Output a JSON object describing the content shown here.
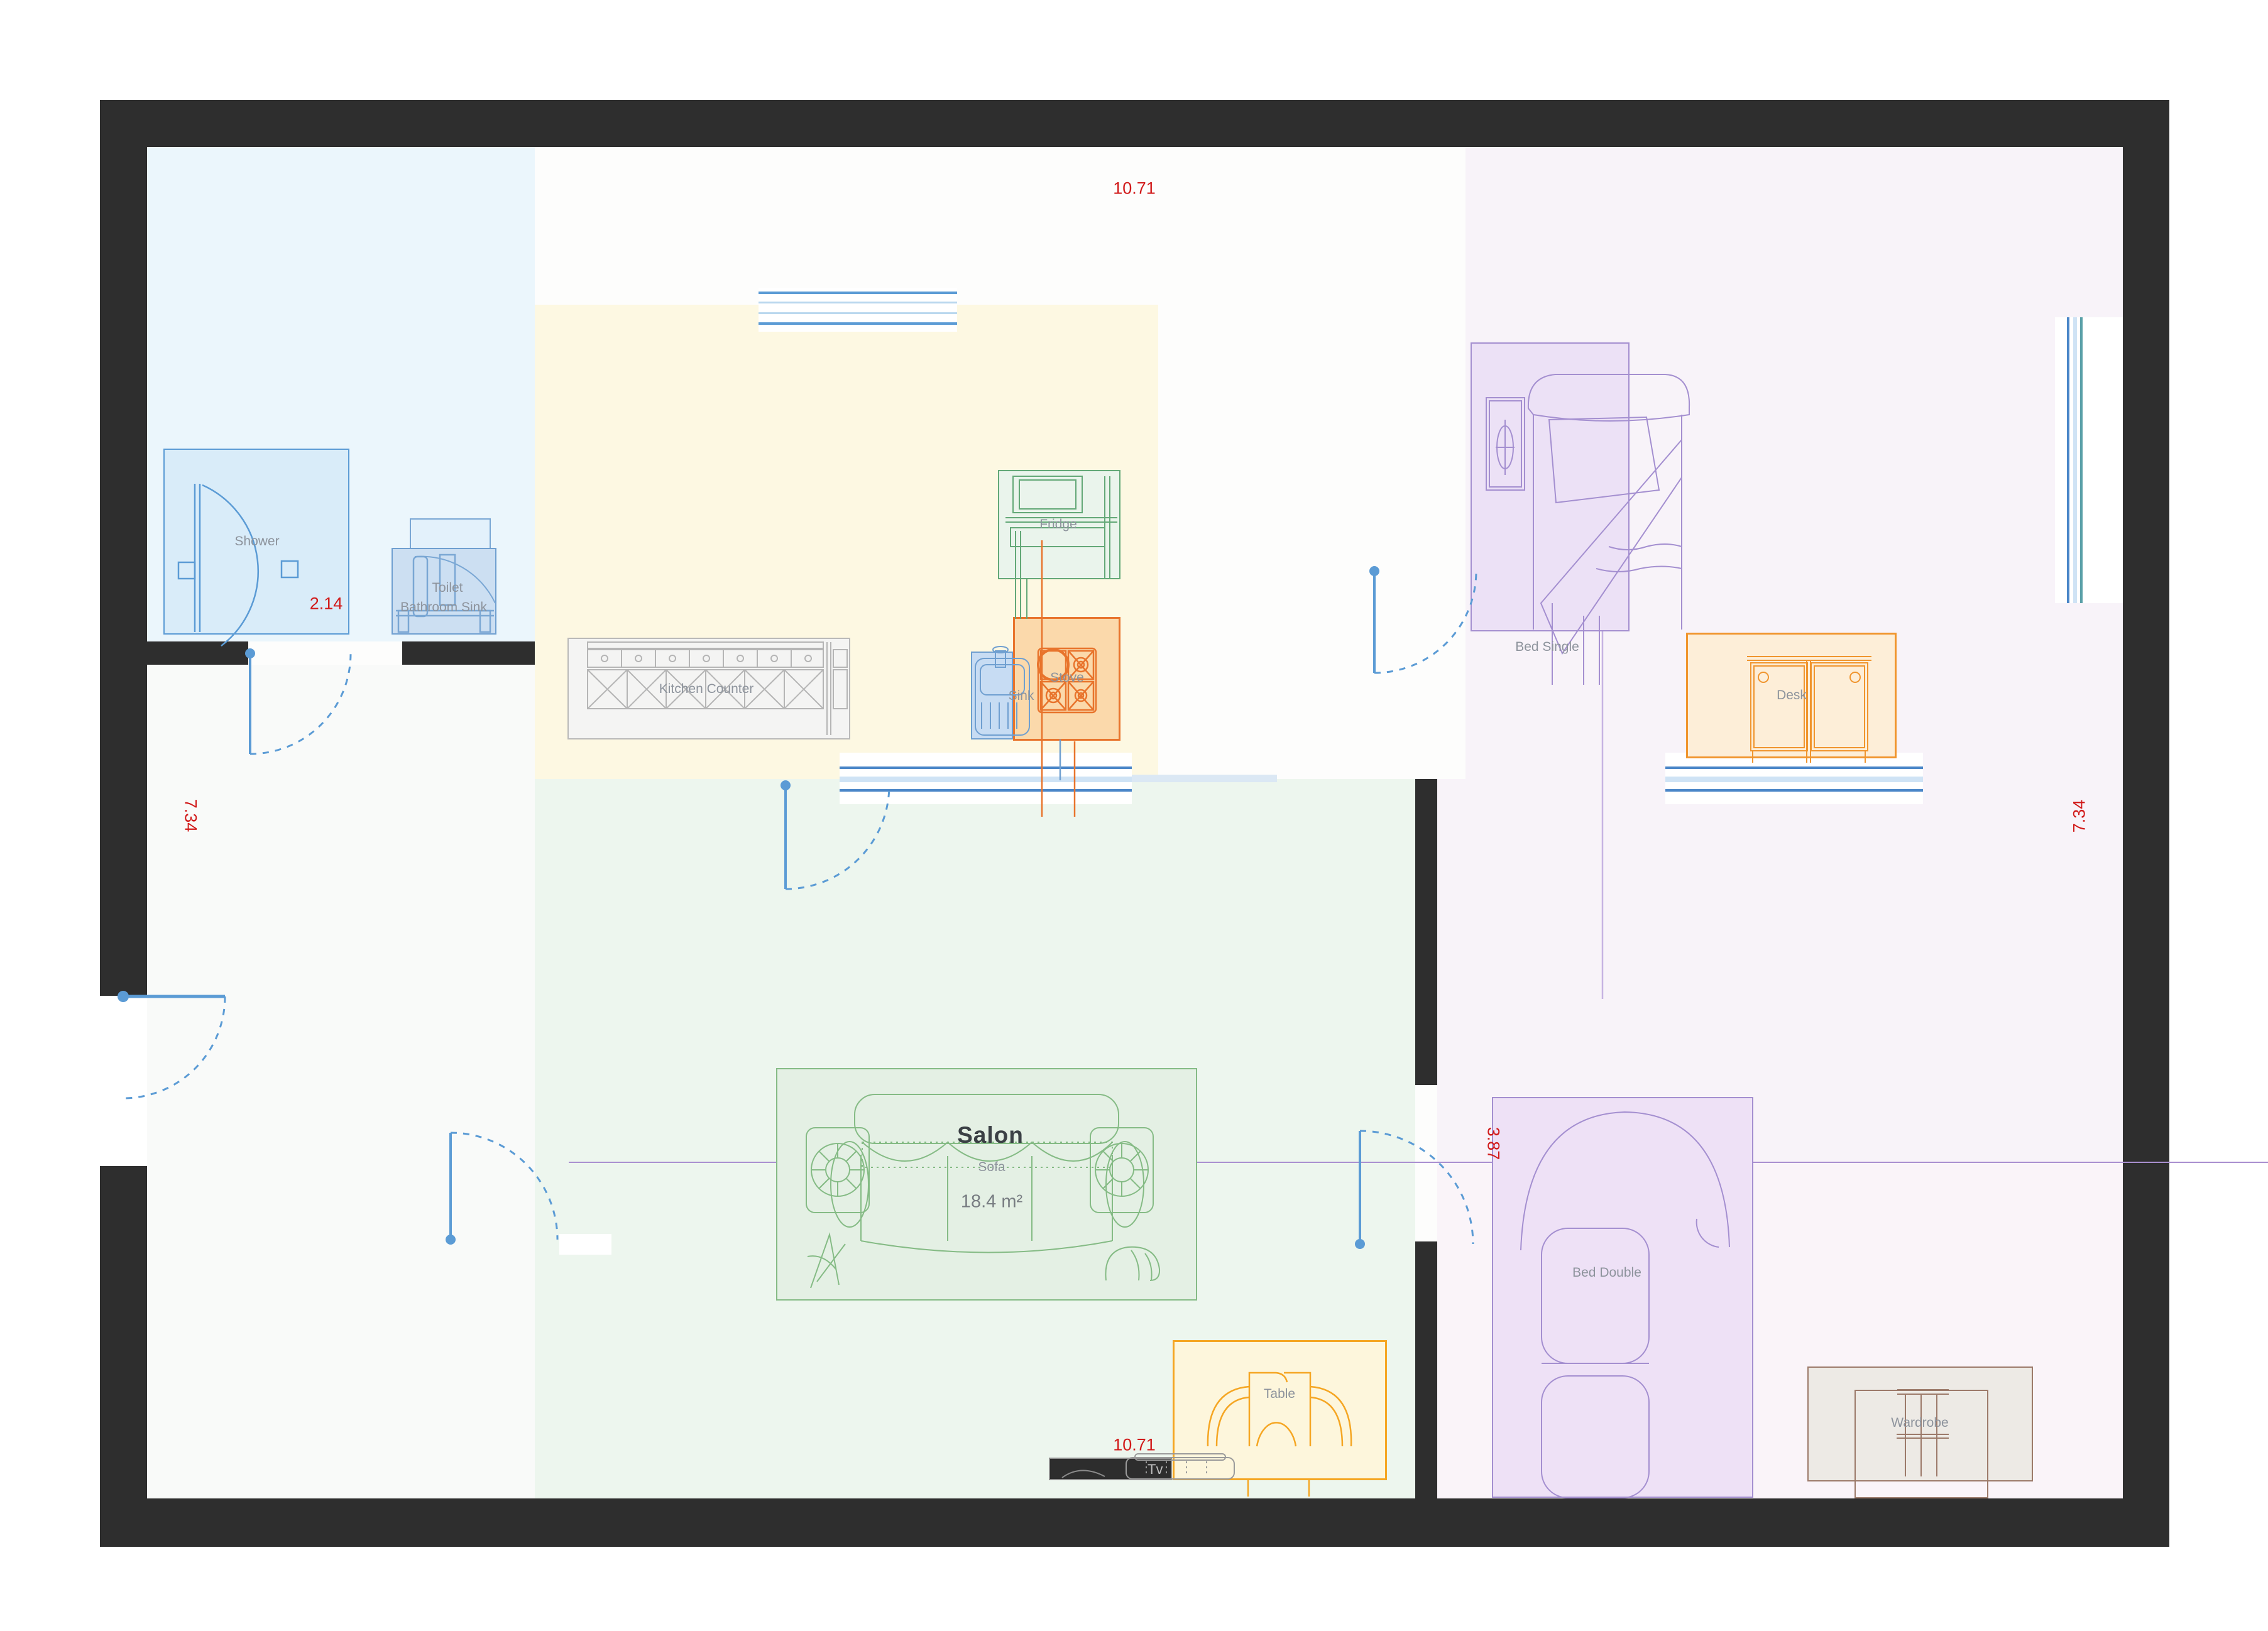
{
  "plan": {
    "type": "apartment floor plan",
    "wall_color": "#2e2e2e",
    "accent_blue": "#5b9bd5",
    "dimension_color": "#d11a1a"
  },
  "rooms": [
    {
      "name": "Lazienka",
      "area": "5.7 m²"
    },
    {
      "name": "Kuchnia",
      "area": "8.5 m²"
    },
    {
      "name": "Pokoj dzienny",
      "area": "12.0 m²"
    },
    {
      "name": "Przedpokoj",
      "area": "9.7 m²"
    },
    {
      "name": "Salon",
      "area": "18.4 m²"
    },
    {
      "name": "Sypialnia",
      "area": "14.7 m²"
    }
  ],
  "furniture": {
    "shower": "Shower",
    "toilet": "Toilet",
    "bathroom_sink": "Bathroom Sink",
    "kitchen_counter": "Kitchen Counter",
    "fridge": "Fridge",
    "stove": "Stove",
    "sink": "Sink",
    "bed_single": "Bed Single",
    "desk": "Desk",
    "sofa": "Sofa",
    "table": "Table",
    "tv": "Tv",
    "bed_double": "Bed Double",
    "wardrobe": "Wardrobe"
  },
  "dimensions": {
    "top_width": "10.71",
    "bottom_width": "10.71",
    "left_height": "7.34",
    "right_height": "7.34",
    "bathroom_width": "2.14",
    "bedroom_width": "3.87"
  }
}
